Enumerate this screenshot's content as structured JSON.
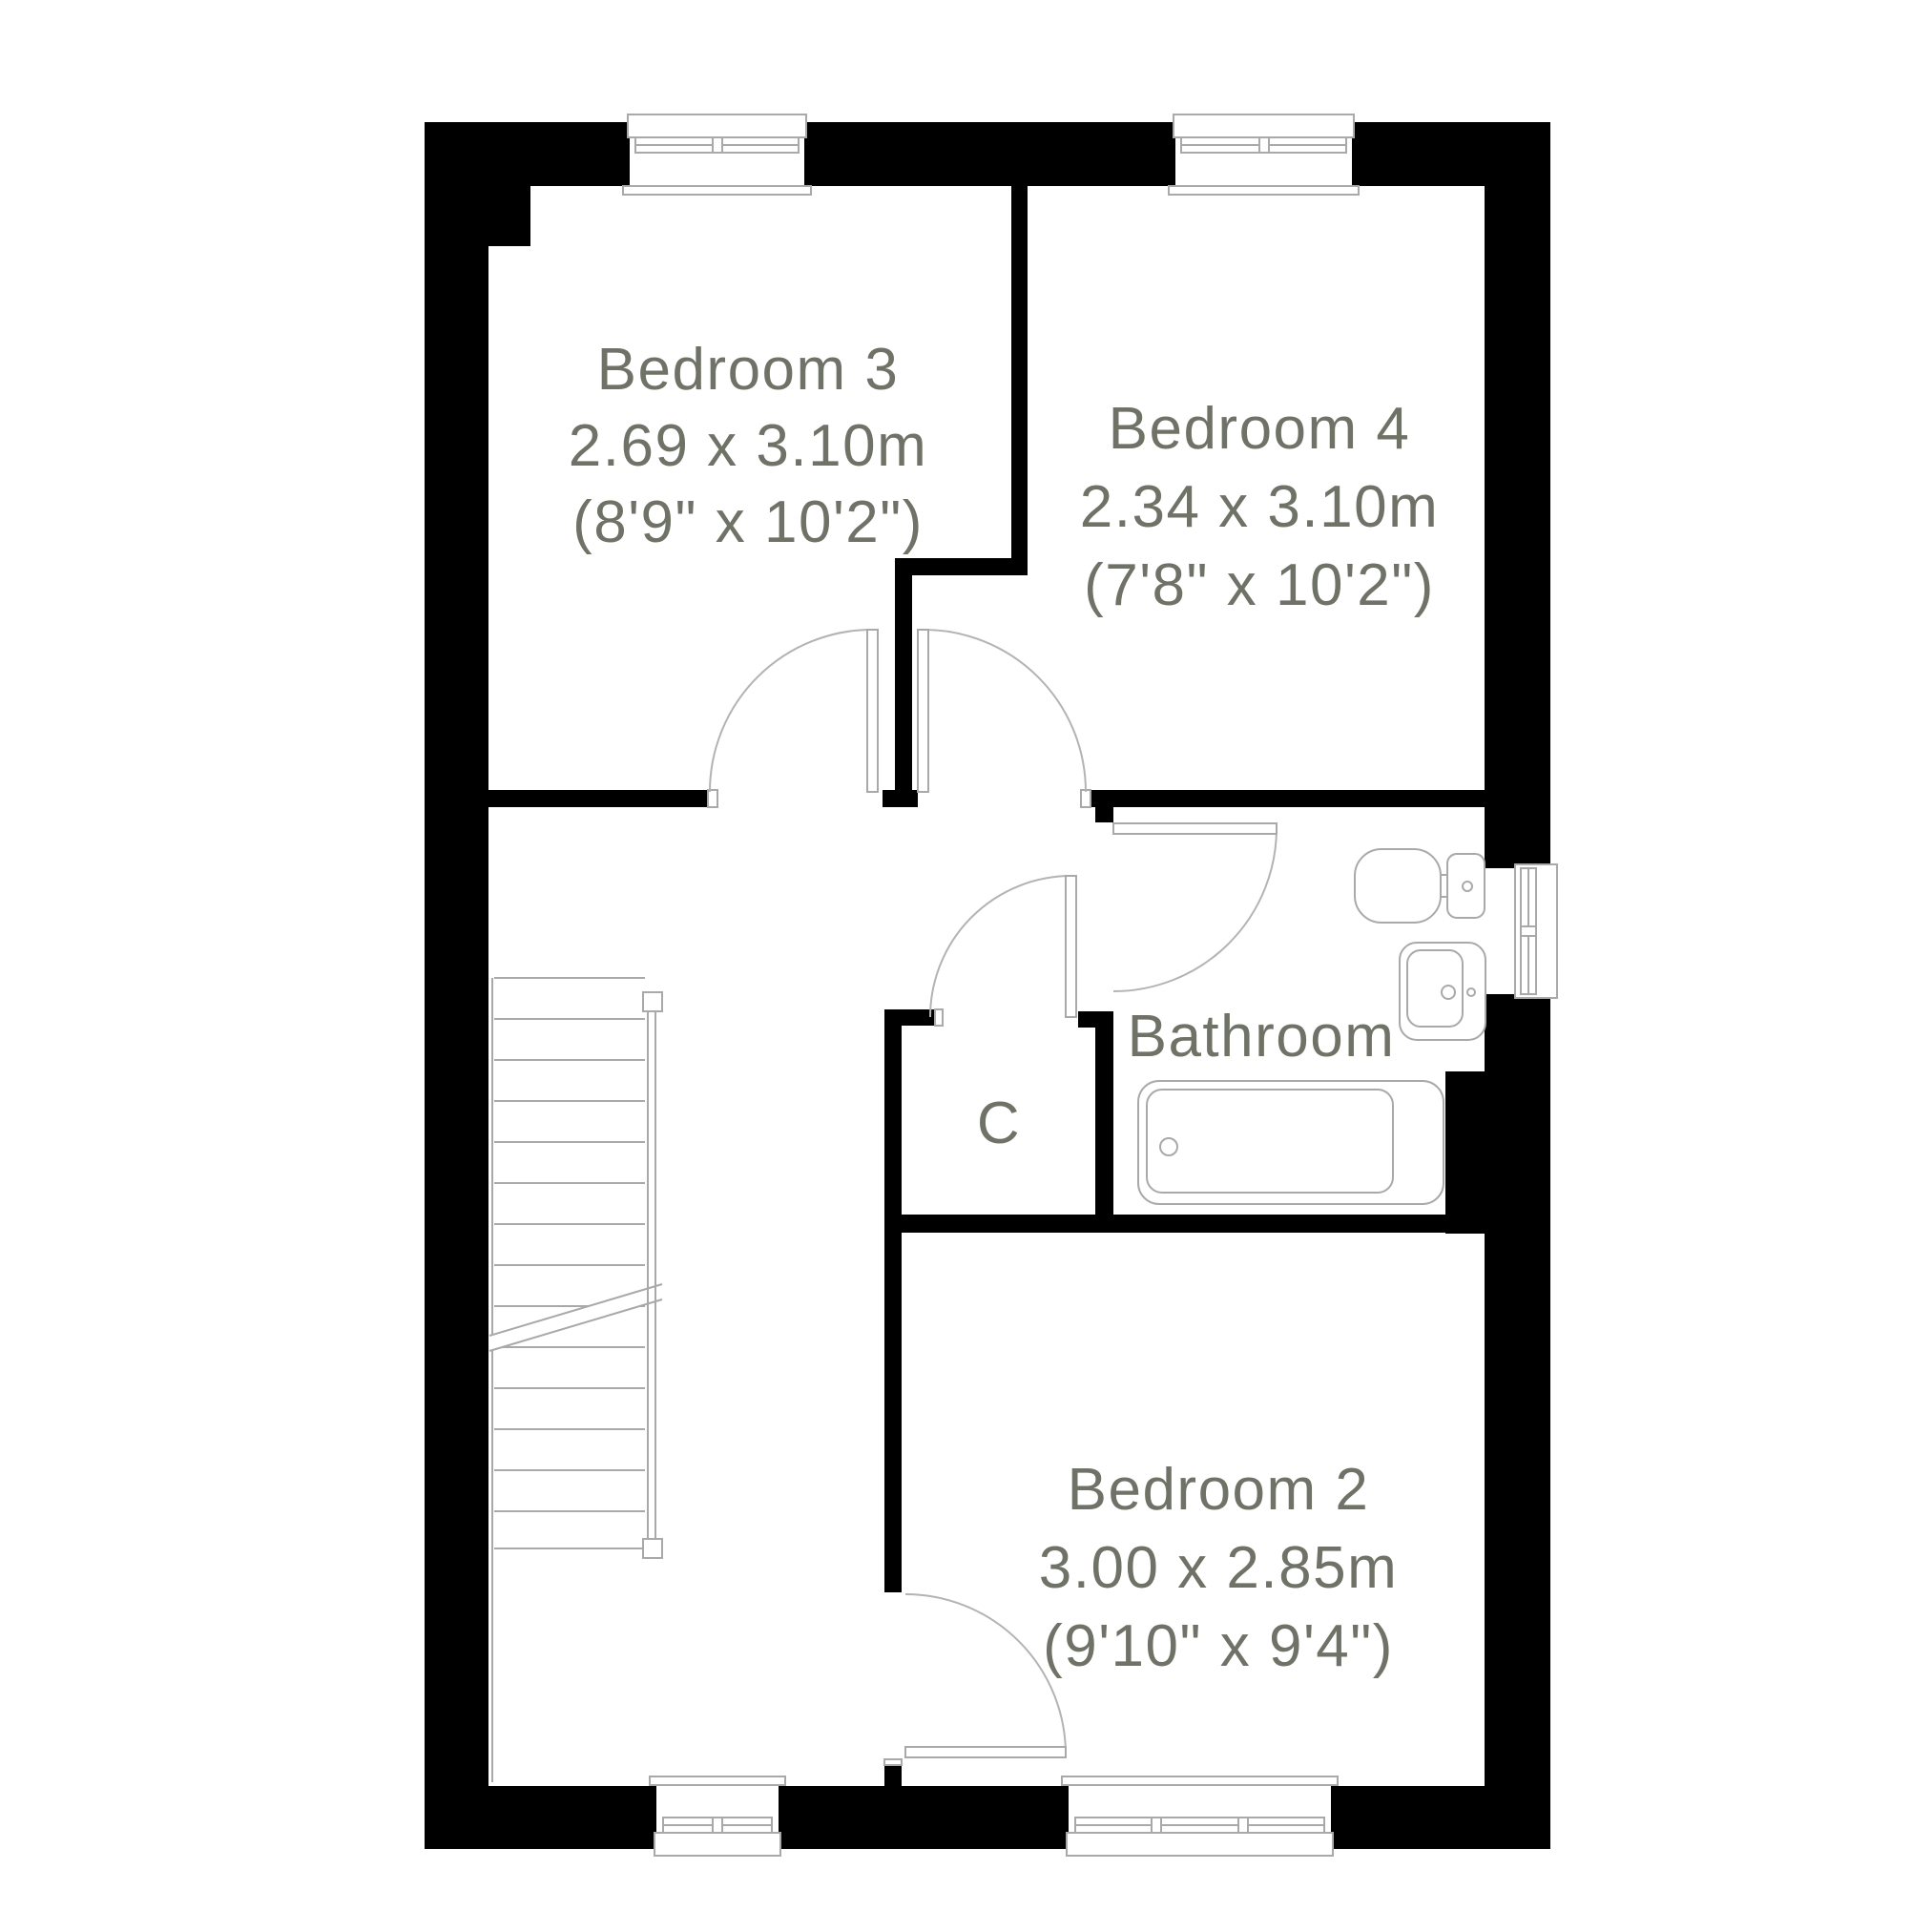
{
  "plan": {
    "type": "floor-plan",
    "rooms": {
      "bedroom3": {
        "name": "Bedroom 3",
        "metric": "2.69 x 3.10m",
        "imperial": "(8'9\" x 10'2\")"
      },
      "bedroom4": {
        "name": "Bedroom 4",
        "metric": "2.34 x 3.10m",
        "imperial": "(7'8\" x 10'2\")"
      },
      "bathroom": {
        "name": "Bathroom"
      },
      "cupboard": {
        "name": "C"
      },
      "bedroom2": {
        "name": "Bedroom 2",
        "metric": "3.00 x 2.85m",
        "imperial": "(9'10\" x 9'4\")"
      }
    },
    "colors": {
      "wall": "#000000",
      "fixture_line": "#a9a9a9",
      "door_arc_line": "#b3b3b3",
      "label_text": "#6f7267",
      "background": "#ffffff"
    }
  }
}
